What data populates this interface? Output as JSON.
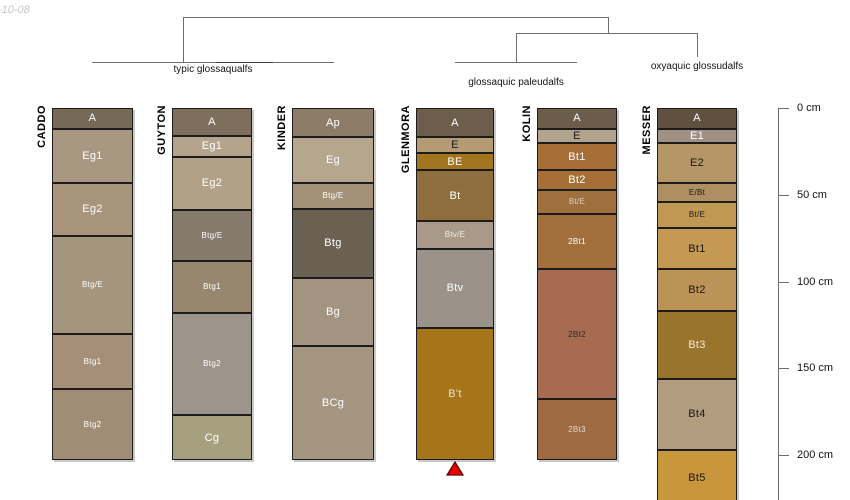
{
  "meta": {
    "timestamp_fragment": "-10-08"
  },
  "chart_data": {
    "type": "soil-profile-columns-with-dendrogram",
    "depth_axis": {
      "unit": "cm",
      "axis_x_px": 778,
      "px_origin_y": 108,
      "px_per_cm": 1.735,
      "axis_bottom_px": 500,
      "ticks_cm": [
        0,
        50,
        100,
        150,
        200
      ],
      "tick_labels": [
        "0 cm",
        "50 cm",
        "100 cm",
        "150 cm",
        "200 cm"
      ]
    },
    "groups": [
      {
        "label": "typic glossaqualfs",
        "members": [
          "CADDO",
          "GUYTON",
          "KINDER"
        ],
        "label_cx_px": 213,
        "label_top_px": 64
      },
      {
        "label": "glossaquic paleudalfs",
        "members": [
          "GLENMORA",
          "KOLIN"
        ],
        "label_cx_px": 516,
        "label_top_px": 77
      },
      {
        "label": "oxyaquic glossudalfs",
        "members": [
          "MESSER"
        ],
        "label_cx_px": 697,
        "label_top_px": 61
      }
    ],
    "dendrogram": {
      "line_color": "#6e6e6e",
      "overlap_color": "#3f3f3f",
      "segments": [
        {
          "x1": 183,
          "y1": 17,
          "x2": 608,
          "y2": 17
        },
        {
          "x1": 183,
          "y1": 17,
          "x2": 183,
          "y2": 62
        },
        {
          "x1": 92,
          "y1": 62,
          "x2": 334,
          "y2": 62
        },
        {
          "x1": 216,
          "y1": 62,
          "x2": 273,
          "y2": 62,
          "dark": true
        },
        {
          "x1": 608,
          "y1": 17,
          "x2": 608,
          "y2": 33
        },
        {
          "x1": 516,
          "y1": 33,
          "x2": 697,
          "y2": 33
        },
        {
          "x1": 516,
          "y1": 33,
          "x2": 516,
          "y2": 62
        },
        {
          "x1": 455,
          "y1": 62,
          "x2": 577,
          "y2": 62
        },
        {
          "x1": 697,
          "y1": 33,
          "x2": 697,
          "y2": 57
        }
      ]
    },
    "marker_color": "#e60000",
    "marker_edge_color": "#5a0000",
    "profiles": [
      {
        "name": "CADDO",
        "left_px": 52,
        "width_px": 81,
        "marker": false,
        "horizons": [
          {
            "name": "A",
            "top_cm": 0,
            "bottom_cm": 12,
            "color": "#776957",
            "label_color": "#ffffff"
          },
          {
            "name": "Eg1",
            "top_cm": 12,
            "bottom_cm": 43,
            "color": "#a99881",
            "label_color": "#ffffff"
          },
          {
            "name": "Eg2",
            "top_cm": 43,
            "bottom_cm": 74,
            "color": "#a8957b",
            "label_color": "#ffffff"
          },
          {
            "name": "Btg/E",
            "top_cm": 74,
            "bottom_cm": 130,
            "color": "#a4957f",
            "label_color": "#ffffff"
          },
          {
            "name": "Btg1",
            "top_cm": 130,
            "bottom_cm": 162,
            "color": "#a68f79",
            "label_color": "#ffffff"
          },
          {
            "name": "Btg2",
            "top_cm": 162,
            "bottom_cm": 203,
            "color": "#a08d75",
            "label_color": "#ffffff"
          }
        ]
      },
      {
        "name": "GUYTON",
        "left_px": 172,
        "width_px": 80,
        "marker": false,
        "horizons": [
          {
            "name": "A",
            "top_cm": 0,
            "bottom_cm": 16,
            "color": "#7e6f5c",
            "label_color": "#ffffff"
          },
          {
            "name": "Eg1",
            "top_cm": 16,
            "bottom_cm": 28,
            "color": "#b4a48c",
            "label_color": "#ffffff"
          },
          {
            "name": "Eg2",
            "top_cm": 28,
            "bottom_cm": 59,
            "color": "#b1a287",
            "label_color": "#ffffff"
          },
          {
            "name": "Btg/E",
            "top_cm": 59,
            "bottom_cm": 88,
            "color": "#857a6b",
            "label_color": "#ffffff"
          },
          {
            "name": "Btg1",
            "top_cm": 88,
            "bottom_cm": 118,
            "color": "#97876f",
            "label_color": "#ffffff"
          },
          {
            "name": "Btg2",
            "top_cm": 118,
            "bottom_cm": 177,
            "color": "#9d948a",
            "label_color": "#ffffff"
          },
          {
            "name": "Cg",
            "top_cm": 177,
            "bottom_cm": 203,
            "color": "#a7a07e",
            "label_color": "#ffffff"
          }
        ]
      },
      {
        "name": "KINDER",
        "left_px": 292,
        "width_px": 82,
        "marker": false,
        "horizons": [
          {
            "name": "Ap",
            "top_cm": 0,
            "bottom_cm": 17,
            "color": "#8c7c68",
            "label_color": "#ffffff"
          },
          {
            "name": "Eg",
            "top_cm": 17,
            "bottom_cm": 43,
            "color": "#b5a68e",
            "label_color": "#ffffff"
          },
          {
            "name": "Btg/E",
            "top_cm": 43,
            "bottom_cm": 58,
            "color": "#a29177",
            "label_color": "#ffffff"
          },
          {
            "name": "Btg",
            "top_cm": 58,
            "bottom_cm": 98,
            "color": "#6b6152",
            "label_color": "#ffffff"
          },
          {
            "name": "Bg",
            "top_cm": 98,
            "bottom_cm": 137,
            "color": "#a29480",
            "label_color": "#ffffff"
          },
          {
            "name": "BCg",
            "top_cm": 137,
            "bottom_cm": 203,
            "color": "#a59681",
            "label_color": "#ffffff"
          }
        ]
      },
      {
        "name": "GLENMORA",
        "left_px": 416,
        "width_px": 78,
        "marker": true,
        "horizons": [
          {
            "name": "A",
            "top_cm": 0,
            "bottom_cm": 17,
            "color": "#6d5d4b",
            "label_color": "#ffffff"
          },
          {
            "name": "E",
            "top_cm": 17,
            "bottom_cm": 26,
            "color": "#b49b73",
            "label_color": "#1a1a1a"
          },
          {
            "name": "BE",
            "top_cm": 26,
            "bottom_cm": 36,
            "color": "#a2741d",
            "label_color": "#ffffff"
          },
          {
            "name": "Bt",
            "top_cm": 36,
            "bottom_cm": 65,
            "color": "#8f6e3e",
            "label_color": "#ffffff"
          },
          {
            "name": "Btv/E",
            "top_cm": 65,
            "bottom_cm": 81,
            "color": "#a89a86",
            "label_color": "#f2ede5"
          },
          {
            "name": "Btv",
            "top_cm": 81,
            "bottom_cm": 127,
            "color": "#9b9289",
            "label_color": "#ffffff"
          },
          {
            "name": "B't",
            "top_cm": 127,
            "bottom_cm": 203,
            "color": "#a6751a",
            "label_color": "#e8e0d2"
          }
        ]
      },
      {
        "name": "KOLIN",
        "left_px": 537,
        "width_px": 80,
        "marker": false,
        "horizons": [
          {
            "name": "A",
            "top_cm": 0,
            "bottom_cm": 12,
            "color": "#6b5c4b",
            "label_color": "#ffffff"
          },
          {
            "name": "E",
            "top_cm": 12,
            "bottom_cm": 20,
            "color": "#b2a48c",
            "label_color": "#1a1a1a"
          },
          {
            "name": "Bt1",
            "top_cm": 20,
            "bottom_cm": 36,
            "color": "#a76f38",
            "label_color": "#ffffff"
          },
          {
            "name": "Bt2",
            "top_cm": 36,
            "bottom_cm": 47,
            "color": "#a76f38",
            "label_color": "#ffffff"
          },
          {
            "name": "Bt/E",
            "top_cm": 47,
            "bottom_cm": 61,
            "color": "#a06f3e",
            "label_color": "#ddd3c2"
          },
          {
            "name": "2Bt1",
            "top_cm": 61,
            "bottom_cm": 93,
            "color": "#a26f3d",
            "label_color": "#ffffff"
          },
          {
            "name": "2Bt2",
            "top_cm": 93,
            "bottom_cm": 168,
            "color": "#a76b51",
            "label_color": "#2a2a2a"
          },
          {
            "name": "2Bt3",
            "top_cm": 168,
            "bottom_cm": 203,
            "color": "#9f6a42",
            "label_color": "#e3d9c8"
          }
        ]
      },
      {
        "name": "MESSER",
        "left_px": 657,
        "width_px": 80,
        "marker": false,
        "horizons": [
          {
            "name": "A",
            "top_cm": 0,
            "bottom_cm": 12,
            "color": "#60503f",
            "label_color": "#ffffff"
          },
          {
            "name": "E1",
            "top_cm": 12,
            "bottom_cm": 20,
            "color": "#a19184",
            "label_color": "#ffffff"
          },
          {
            "name": "E2",
            "top_cm": 20,
            "bottom_cm": 43,
            "color": "#b59767",
            "label_color": "#1a1a1a"
          },
          {
            "name": "E/Bt",
            "top_cm": 43,
            "bottom_cm": 54,
            "color": "#ae8e63",
            "label_color": "#1a1a1a"
          },
          {
            "name": "Bt/E",
            "top_cm": 54,
            "bottom_cm": 69,
            "color": "#c09753",
            "label_color": "#1a1a1a"
          },
          {
            "name": "Bt1",
            "top_cm": 69,
            "bottom_cm": 93,
            "color": "#c49952",
            "label_color": "#1a1a1a"
          },
          {
            "name": "Bt2",
            "top_cm": 93,
            "bottom_cm": 117,
            "color": "#bb9356",
            "label_color": "#1a1a1a"
          },
          {
            "name": "Bt3",
            "top_cm": 117,
            "bottom_cm": 156,
            "color": "#9b742c",
            "label_color": "#f0e8da"
          },
          {
            "name": "Bt4",
            "top_cm": 156,
            "bottom_cm": 197,
            "color": "#b29c80",
            "label_color": "#1a1a1a"
          },
          {
            "name": "Bt5",
            "top_cm": 197,
            "bottom_cm": 229,
            "color": "#c8963c",
            "label_color": "#1a1a1a"
          }
        ]
      }
    ]
  }
}
